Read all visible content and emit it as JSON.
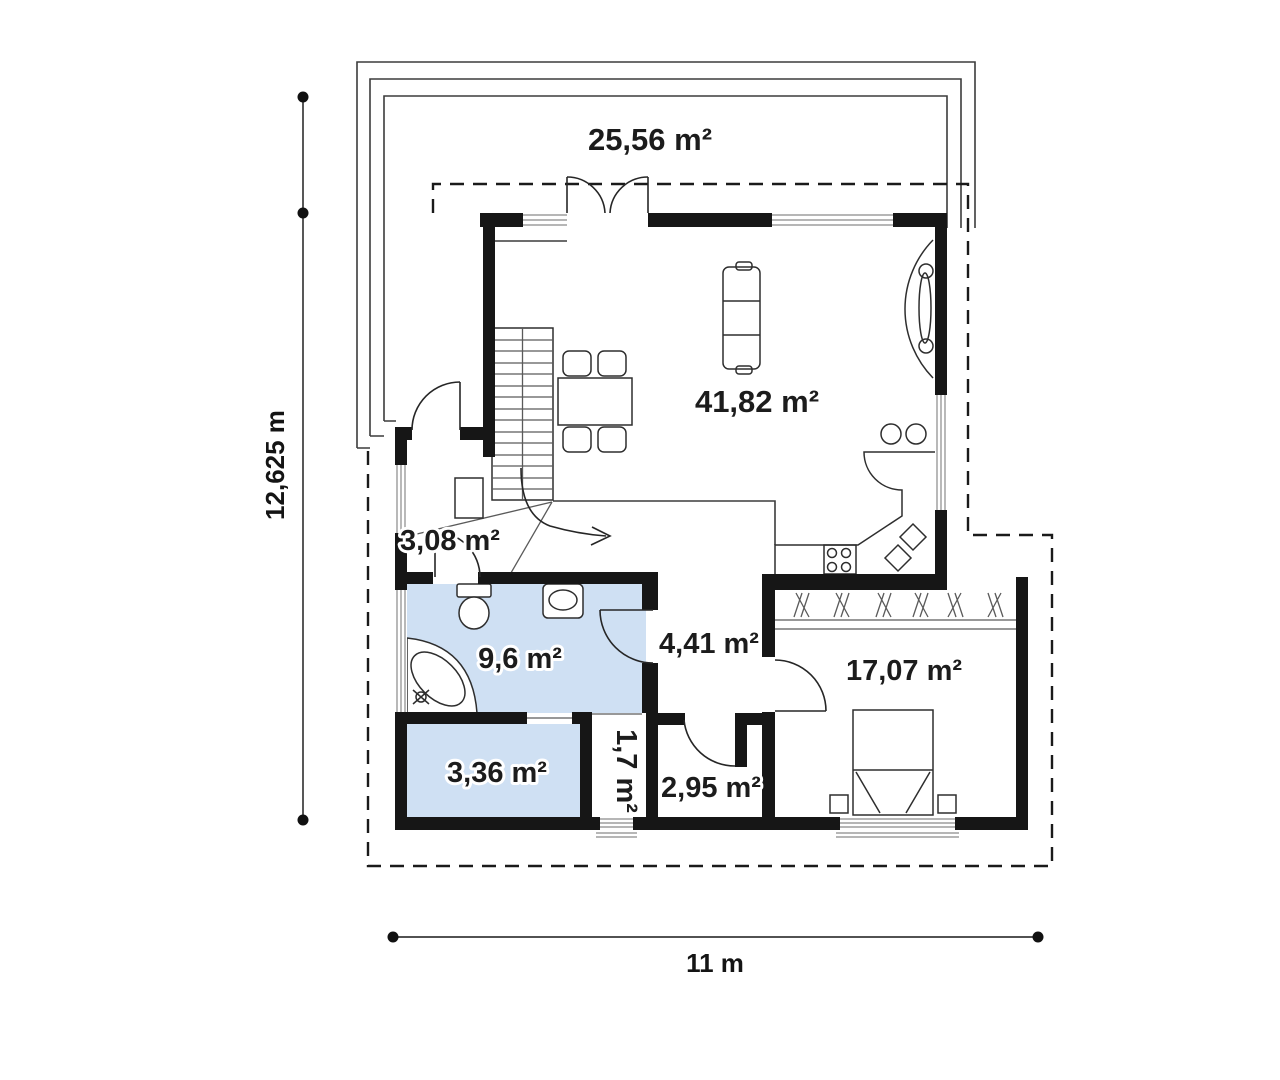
{
  "plan": {
    "labels": {
      "terrace": "25,56 m²",
      "living": "41,82 m²",
      "vestibule": "3,08 m²",
      "bathroom": "9,6 m²",
      "hall": "4,41 m²",
      "bedroom": "17,07 m²",
      "storage": "3,36 m²",
      "closet": "1,7 m²",
      "wc": "2,95 m²"
    },
    "dimensions": {
      "height": "12,625 m",
      "width": "11 m"
    },
    "colors": {
      "wall": "#161616",
      "room_fill": "#cfe0f3",
      "furniture_fill": "#c7dcf2",
      "line": "#3c3c3c",
      "dashed_outline": "#1a1a1a",
      "text": "#1c1c1c"
    }
  }
}
